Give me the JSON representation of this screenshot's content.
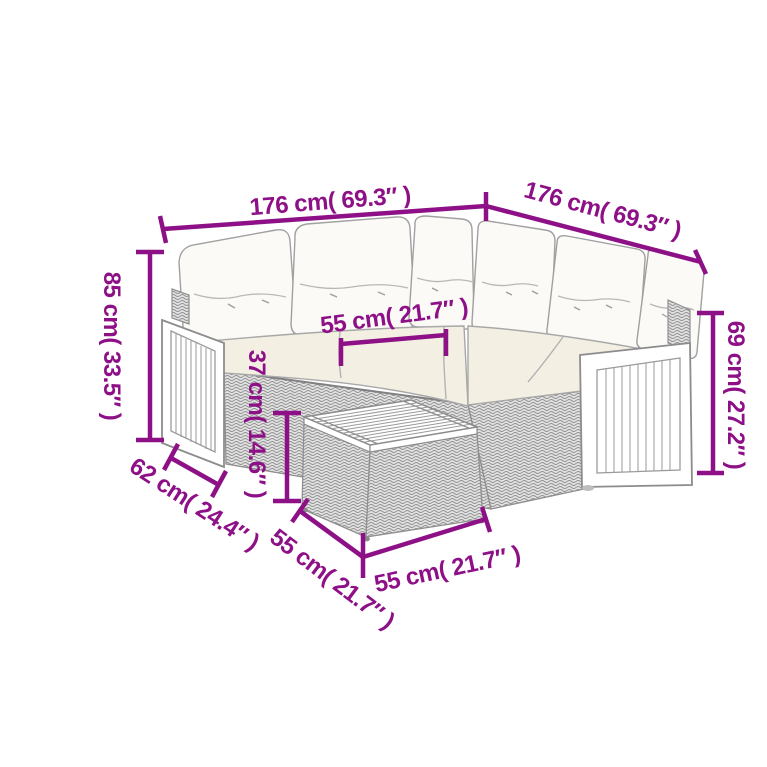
{
  "diagram": {
    "type": "product-dimension-diagram",
    "subject": "rattan corner sofa set with coffee table"
  },
  "colors": {
    "dimension_accent": "#8E1087",
    "line_gray": "#999999",
    "cushion_white": "#fbfaf6",
    "seat_cream": "#f3efe3",
    "rattan_bg": "#e2e2e2",
    "rattan_stroke": "#909090",
    "background": "#ffffff"
  },
  "dimensions": {
    "back_width_left": {
      "label": "176 cm( 69.3″ )"
    },
    "back_width_right": {
      "label": "176 cm( 69.3″ )"
    },
    "total_height": {
      "label": "85 cm( 33.5″ )"
    },
    "seat_width": {
      "label": "55 cm( 21.7″ )"
    },
    "table_height": {
      "label": "37 cm( 14.6″ )"
    },
    "back_height": {
      "label": "69 cm( 27.2″ )"
    },
    "arm_depth": {
      "label": "62 cm( 24.4″ )"
    },
    "table_side_left": {
      "label": "55 cm( 21.7″ )"
    },
    "table_side_front": {
      "label": "55 cm( 21.7″ )"
    }
  }
}
